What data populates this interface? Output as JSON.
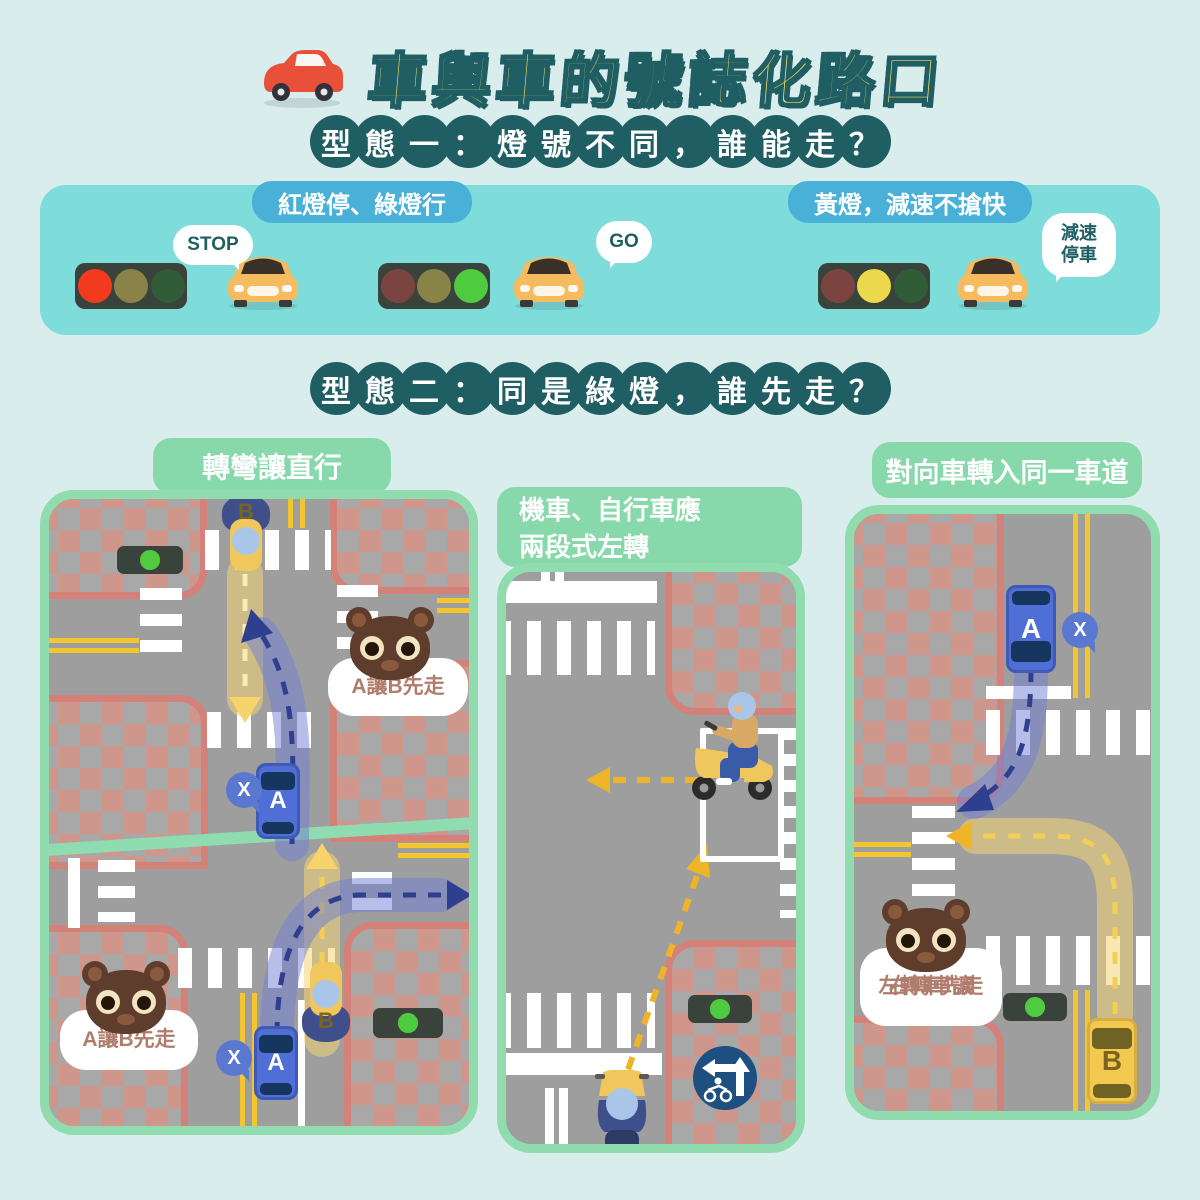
{
  "title": {
    "text": "車與車的號誌化路口"
  },
  "headings": {
    "type1": "型態一：燈號不同，誰能走？",
    "type2": "型態二：同是綠燈，誰先走？"
  },
  "banner": {
    "label_red_green": "紅燈停、綠燈行",
    "label_yellow": "黃燈，減速不搶快",
    "bubble_stop": "STOP",
    "bubble_go": "GO",
    "bubble_slow_line1": "減速",
    "bubble_slow_line2": "停車"
  },
  "panels": {
    "turn_yield": {
      "header": "轉彎讓直行",
      "bubble_top": "A讓B先走",
      "bubble_bottom": "A讓B先走"
    },
    "two_stage": {
      "header_line1": "機車、自行車應",
      "header_line2": "兩段式左轉"
    },
    "oncoming": {
      "header": "對向車轉入同一車道",
      "bubble_line1": "右轉車讓",
      "bubble_line2": "左轉車先走"
    }
  },
  "labels": {
    "car_a": "A",
    "car_b": "B",
    "no_badge": "X"
  },
  "colors": {
    "background": "#d9edec",
    "banner": "#7edcda",
    "banner_label": "#49b0d8",
    "heading_circle": "#1f5e63",
    "title_fill": "#f6d96b",
    "panel_green": "#87d8aa",
    "panel_border": "#90dcae",
    "road": "#9e9e9e",
    "checker_pink": "#cf968c",
    "checker_border": "#d4817a",
    "lane_yellow": "#f3c52f",
    "car_blue": "#4f6fd6",
    "car_yellow": "#f3c84e",
    "arrow_blue": "#2f3f8f",
    "arrow_yellow": "#f0b429",
    "bear_brown": "#5f3d2c",
    "bubble_text": "#b07d6d",
    "badge_blue": "#5b78d0",
    "sign_navy": "#1d4f80",
    "light_red": "#f23a1e",
    "light_yellow": "#ecd84d",
    "light_green": "#4fcb3f"
  }
}
